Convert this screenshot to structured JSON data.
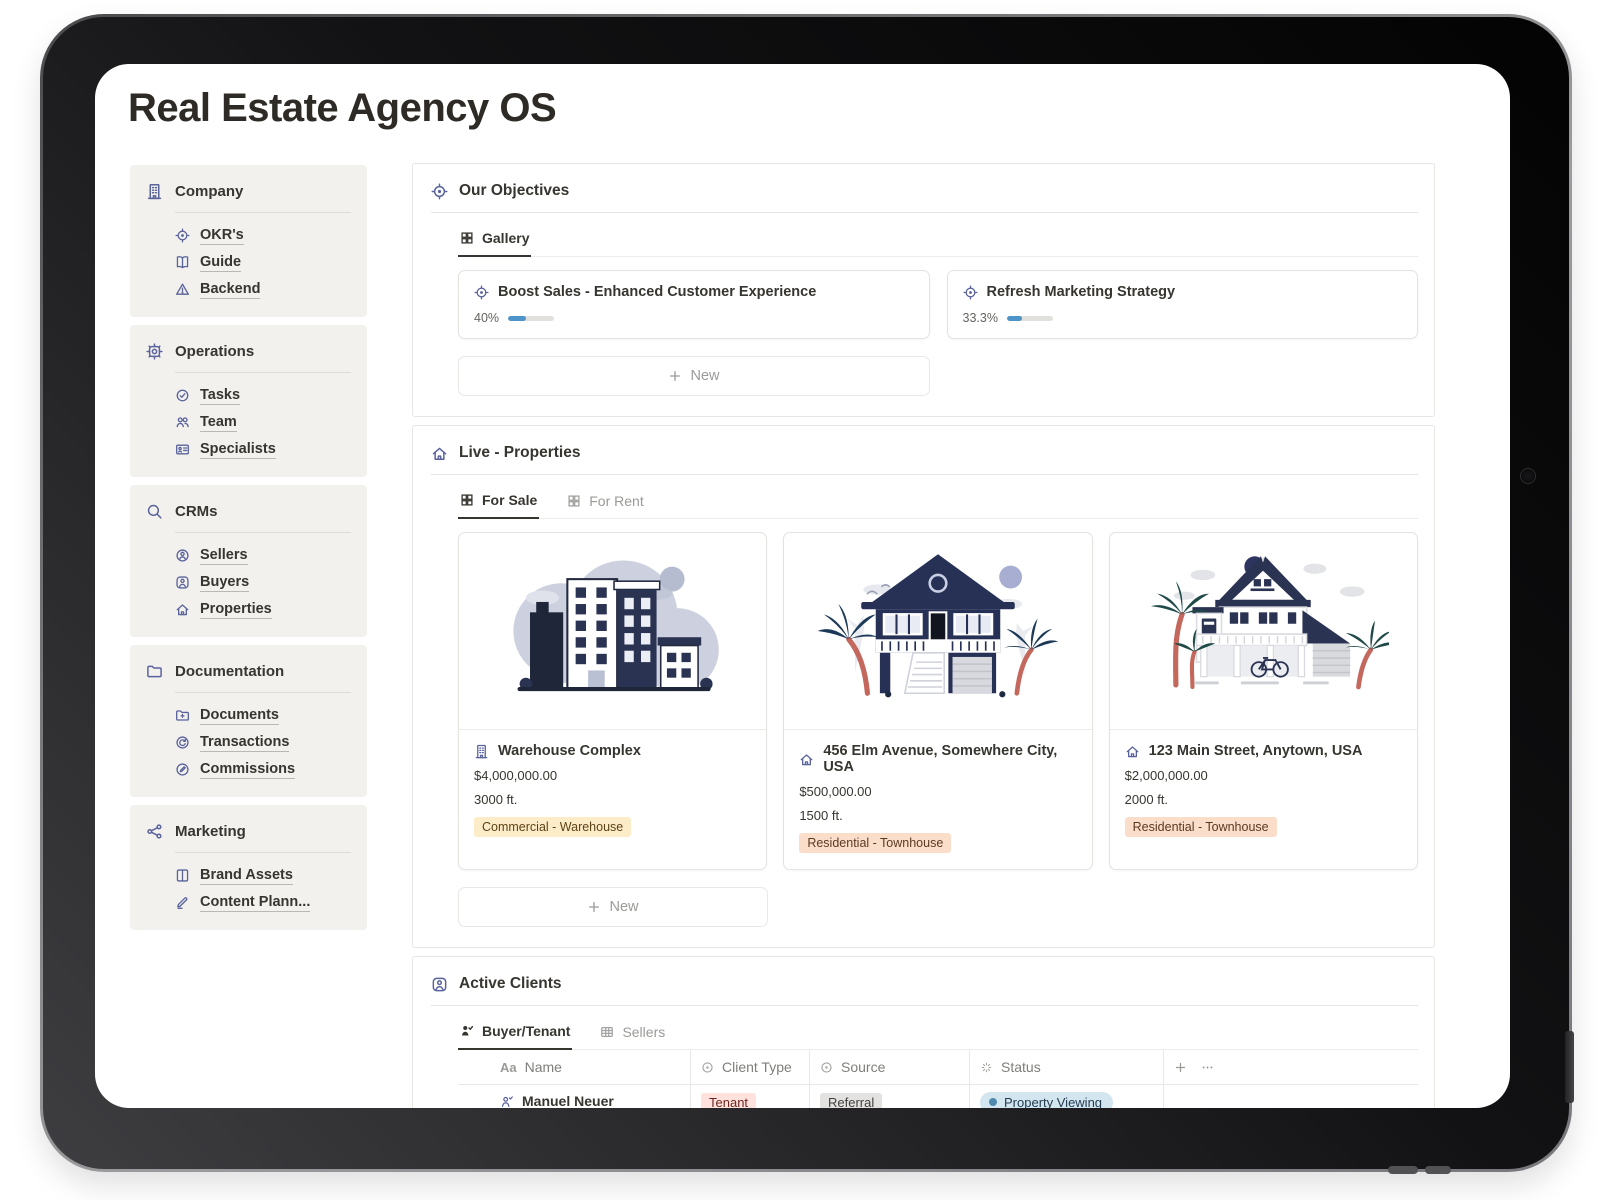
{
  "page_title": "Real Estate Agency OS",
  "sidebar": {
    "sections": [
      {
        "label": "Company",
        "items": [
          {
            "label": "OKR's"
          },
          {
            "label": "Guide"
          },
          {
            "label": "Backend"
          }
        ]
      },
      {
        "label": "Operations",
        "items": [
          {
            "label": "Tasks"
          },
          {
            "label": "Team"
          },
          {
            "label": "Specialists"
          }
        ]
      },
      {
        "label": "CRMs",
        "items": [
          {
            "label": "Sellers"
          },
          {
            "label": "Buyers"
          },
          {
            "label": "Properties"
          }
        ]
      },
      {
        "label": "Documentation",
        "items": [
          {
            "label": "Documents"
          },
          {
            "label": "Transactions"
          },
          {
            "label": "Commissions"
          }
        ]
      },
      {
        "label": "Marketing",
        "items": [
          {
            "label": "Brand Assets"
          },
          {
            "label": "Content Plann..."
          }
        ]
      }
    ]
  },
  "objectives": {
    "title": "Our Objectives",
    "tab_label": "Gallery",
    "cards": [
      {
        "title": "Boost Sales - Enhanced Customer Experience",
        "percent": "40%",
        "fill_style": "width:40%"
      },
      {
        "title": "Refresh Marketing Strategy",
        "percent": "33.3%",
        "fill_style": "width:33.3%"
      }
    ],
    "new_label": "New"
  },
  "properties": {
    "title": "Live - Properties",
    "tabs": [
      {
        "label": "For Sale"
      },
      {
        "label": "For Rent"
      }
    ],
    "cards": [
      {
        "title": "Warehouse Complex",
        "price": "$4,000,000.00",
        "size": "3000 ft.",
        "tag": "Commercial - Warehouse",
        "tag_style": "background:#fdecc8;color:#5c4318"
      },
      {
        "title": "456 Elm Avenue, Somewhere City, USA",
        "price": "$500,000.00",
        "size": "1500 ft.",
        "tag": "Residential - Townhouse",
        "tag_style": "background:#fadec9;color:#5c3a21"
      },
      {
        "title": "123 Main Street, Anytown, USA",
        "price": "$2,000,000.00",
        "size": "2000 ft.",
        "tag": "Residential - Townhouse",
        "tag_style": "background:#fadec9;color:#5c3a21"
      }
    ],
    "new_label": "New"
  },
  "clients": {
    "title": "Active Clients",
    "tabs": [
      {
        "label": "Buyer/Tenant"
      },
      {
        "label": "Sellers"
      }
    ],
    "name_type_icon": "Aa",
    "columns": [
      "Name",
      "Client Type",
      "Source",
      "Status"
    ],
    "rows": [
      {
        "name": "Manuel Neuer",
        "client_type": "Tenant",
        "type_style": "background:#ffe2dd;color:#6d261f",
        "source": "Referral",
        "source_style": "background:#e3e2e0;color:#42403c",
        "status": "Property Viewing"
      },
      {
        "name": "Eden Hazard",
        "client_type": "Buyer",
        "type_style": "background:#e8deee;color:#4a2a5e",
        "source": "Events",
        "source_style": "background:#e3e2e0;color:#42403c",
        "status": "Property Viewing"
      }
    ]
  },
  "colors": {
    "accent_progress_blue": "#4f94c9",
    "icon_indigo": "#5a639c",
    "status_pill_bg": "#d3e5ef",
    "status_dot": "#5089ae",
    "tag_yellow_bg": "#fdecc8",
    "tag_orange_bg": "#fadec9",
    "tag_red_bg": "#ffe2dd",
    "tag_purple_bg": "#e8deee",
    "tag_gray_bg": "#e3e2e0",
    "sidebar_bg": "#f2f1ee"
  }
}
